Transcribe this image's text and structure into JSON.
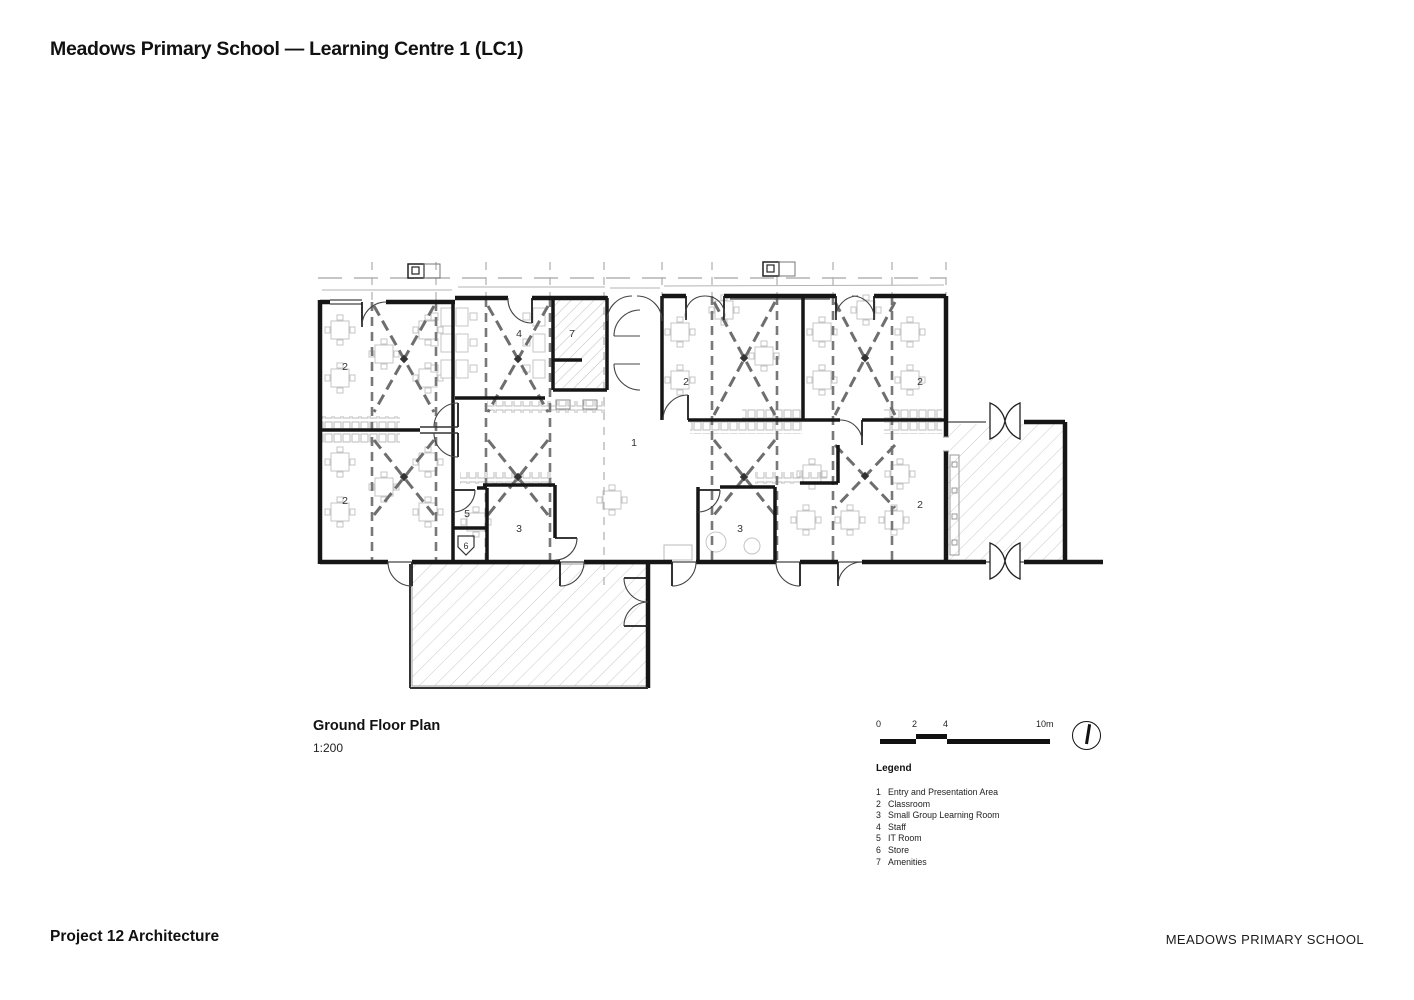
{
  "title": "Meadows Primary School — Learning Centre 1 (LC1)",
  "drawing": {
    "title": "Ground Floor Plan",
    "scale": "1:200"
  },
  "scale_bar": {
    "tick0": "0",
    "tick2": "2",
    "tick4": "4",
    "tick10": "10m"
  },
  "legend": {
    "heading": "Legend",
    "items": [
      {
        "num": "1",
        "label": "Entry and Presentation Area"
      },
      {
        "num": "2",
        "label": "Classroom"
      },
      {
        "num": "3",
        "label": "Small Group Learning Room"
      },
      {
        "num": "4",
        "label": "Staff"
      },
      {
        "num": "5",
        "label": "IT Room"
      },
      {
        "num": "6",
        "label": "Store"
      },
      {
        "num": "7",
        "label": "Amenities"
      }
    ]
  },
  "plan": {
    "room_labels": [
      {
        "room": "classroom-nw",
        "num": "2"
      },
      {
        "room": "classroom-sw",
        "num": "2"
      },
      {
        "room": "staff",
        "num": "4"
      },
      {
        "room": "amenities",
        "num": "7"
      },
      {
        "room": "classroom-n1",
        "num": "2"
      },
      {
        "room": "classroom-n2",
        "num": "2"
      },
      {
        "room": "entry-presentation",
        "num": "1"
      },
      {
        "room": "it-room",
        "num": "5"
      },
      {
        "room": "store",
        "num": "6"
      },
      {
        "room": "small-group-a",
        "num": "3"
      },
      {
        "room": "small-group-b",
        "num": "3"
      },
      {
        "room": "classroom-se",
        "num": "2"
      }
    ]
  },
  "footer": {
    "architect": "Project 12 Architecture",
    "project": "MEADOWS PRIMARY SCHOOL"
  },
  "colors": {
    "ink": "#111111",
    "wall": "#161616",
    "partition": "#6e6e6e",
    "furniture": "#c4c4c4",
    "hatch": "#c9c9c9"
  }
}
